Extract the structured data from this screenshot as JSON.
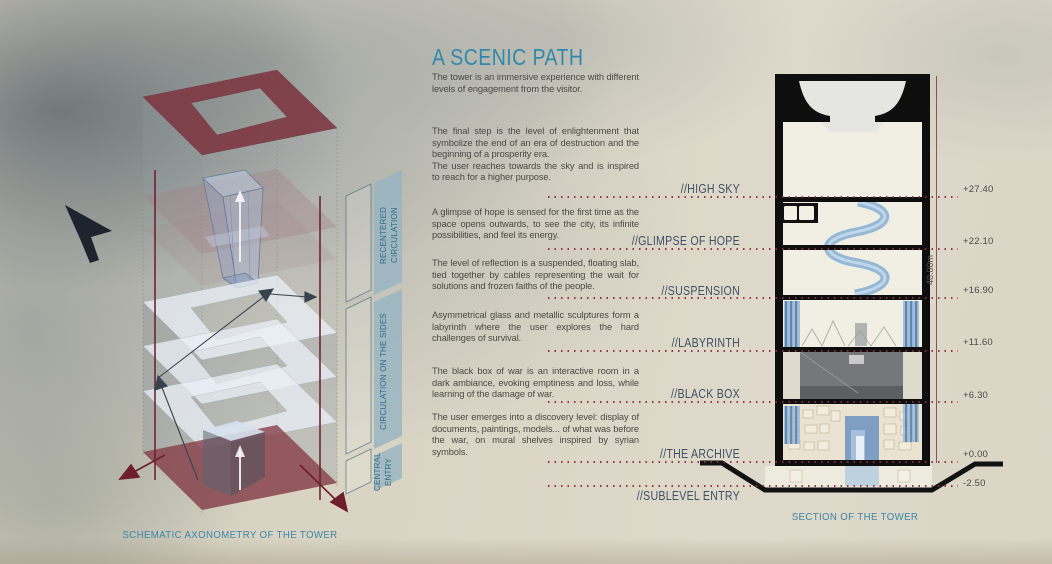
{
  "board": {
    "title": "A SCENIC PATH",
    "intro": "The tower is an immersive experience with different levels of engagement from the visitor.",
    "paragraphs": [
      "The final step is the level of enlightenment that symbolize the end of an era of destruction and the beginning of a prosperity era.\nThe user reaches towards the sky and is inspired to reach for a higher purpose.",
      "A glimpse of hope is sensed for the first time as the space opens outwards, to see the city, its infinite possibilities, and feel its energy.",
      "The level of reflection is a suspended, floating slab, tied together by cables representing the wait for solutions and frozen faiths of the people.",
      "Asymmetrical glass and metallic sculptures form a labyrinth where the user explores the hard challenges of survival.",
      "The black box of war is an interactive room in a dark ambiance, evoking emptiness and loss, while learning of the damage of war.",
      "The user emerges into a discovery level: display of documents, paintings, models... of what was before the war, on mural shelves inspired by syrian symbols."
    ]
  },
  "levels": [
    {
      "label": "//HIGH SKY",
      "elevation": "+27.40"
    },
    {
      "label": "//GLIMPSE OF HOPE",
      "elevation": "+22.10"
    },
    {
      "label": "//SUSPENSION",
      "elevation": "+16.90"
    },
    {
      "label": "//LABYRINTH",
      "elevation": "+11.60"
    },
    {
      "label": "//BLACK BOX",
      "elevation": "+6.30"
    },
    {
      "label": "//THE ARCHIVE",
      "elevation": "+0.00"
    },
    {
      "label": "//SUBLEVEL ENTRY",
      "elevation": "-2.50"
    }
  ],
  "axonometry": {
    "caption": "SCHEMATIC AXONOMETRY OF THE TOWER",
    "annotations": [
      "RECENTERED CIRCULATION",
      "CIRCULATION ON THE SIDES",
      "CENTRAL ENTRY"
    ]
  },
  "section": {
    "caption": "SECTION OF THE TOWER",
    "total_height": "40.00m"
  },
  "colors": {
    "paper": "#d9d4c4",
    "accent_teal": "#3089ad",
    "body_text": "#4a4944",
    "level_label": "#3f5266",
    "dotted_line": "#8b2e3f",
    "axon_maroon": "#8f4a56",
    "section_blue": "#8fb4d6",
    "poche_black": "#0e0e0e"
  }
}
